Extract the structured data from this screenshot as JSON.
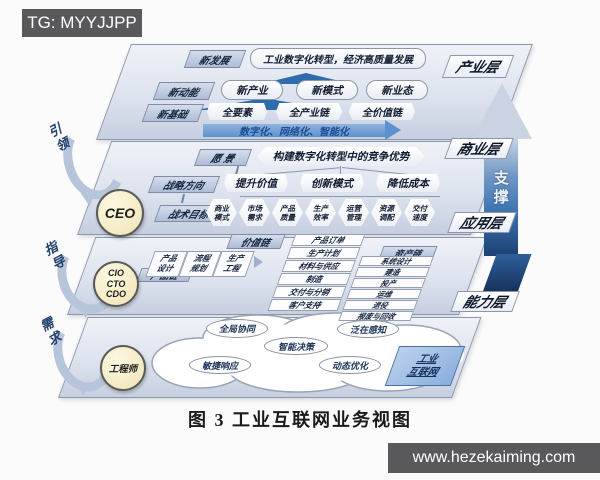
{
  "badges": {
    "top_left": "TG: MYYJJPP",
    "bottom_right": "www.hezekaiming.com"
  },
  "caption": "图 3  工业互联网业务视图",
  "support_arrow": "支撑",
  "left_arrows": [
    "引领",
    "指导",
    "需求"
  ],
  "roles": {
    "ceo": "CEO",
    "cxo": [
      "CIO",
      "CTO",
      "CDO"
    ],
    "engineer": "工程师"
  },
  "layers": {
    "industry": {
      "label": "产业层",
      "row1_chip": "新发展",
      "row1_pill": "工业数字化转型，经济高质量发展",
      "row2_chip": "新动能",
      "row2_pills": [
        "新产业",
        "新模式",
        "新业态"
      ],
      "row3_chip": "新基础",
      "row3_hexes": [
        "全要素",
        "全产业链",
        "全价值链"
      ],
      "arrow": "数字化、网络化、智能化"
    },
    "business": {
      "label": "商业层",
      "vision_chip": "愿 景",
      "vision_pill": "构建数字化转型中的竞争优势",
      "strategy_chip": "战略方向",
      "strategy_pills": [
        "提升价值",
        "创新模式",
        "降低成本"
      ],
      "tactics_chip": "战术目标",
      "tactics_hexes": [
        "商业模式",
        "市场需求",
        "产品质量",
        "生产效率",
        "运营管理",
        "资源调配",
        "交付速度"
      ]
    },
    "application": {
      "label": "应用层",
      "value_chip": "价值链",
      "product_chip": "产品链",
      "asset_chip": "资产链",
      "product_items": [
        "产品设计",
        "流程规划",
        "生产工程"
      ],
      "value_items": [
        "产品订单",
        "生产计划",
        "材料与供应",
        "制造",
        "交付与分销",
        "客户支持"
      ],
      "asset_items": [
        "系统设计",
        "建造",
        "投产",
        "运维",
        "退役",
        "报废与回收"
      ]
    },
    "capability": {
      "label": "能力层",
      "cloud_items": [
        "全局协同",
        "泛在感知",
        "智能决策",
        "敏捷响应",
        "动态优化"
      ],
      "tag_line1": "工业",
      "tag_line2": "互联网"
    }
  },
  "colors": {
    "layer_fill": "#dde3ee",
    "chip_fill": "#aebdd6",
    "accent_triangle": "#2e6cab",
    "flow_arrow": "#5e92cc",
    "support_dark": "#132f57",
    "badge_bg": "#59595c",
    "role_circle": "#f5ecca"
  }
}
